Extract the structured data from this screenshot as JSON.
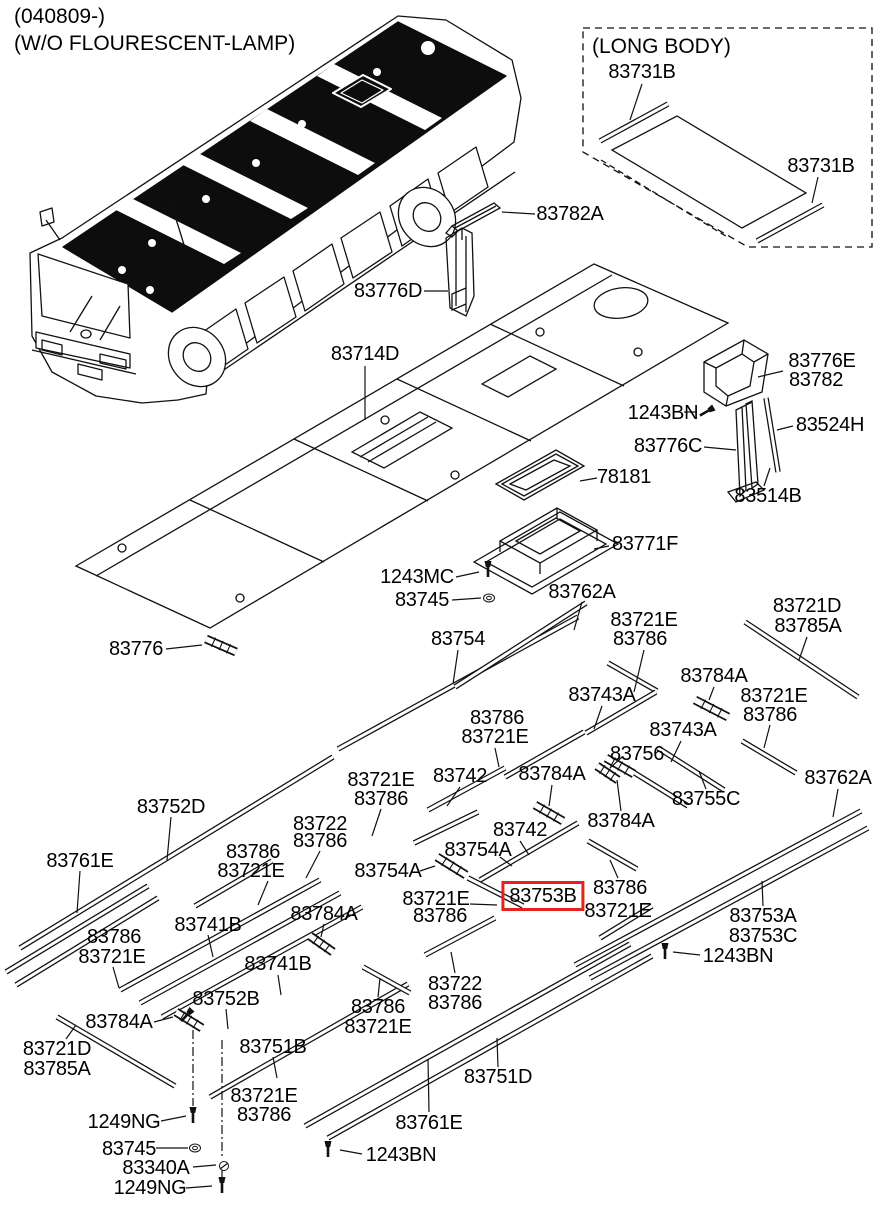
{
  "header": {
    "revision": "(040809-)",
    "variant": "(W/O FLOURESCENT-LAMP)"
  },
  "inset": {
    "title": "(LONG BODY)"
  },
  "highlight": {
    "part": "83753B",
    "color": "#e3231c"
  },
  "colors": {
    "line": "#111111",
    "background": "#ffffff"
  },
  "labels": [
    {
      "t": "83731B",
      "x": 642,
      "y": 72
    },
    {
      "t": "83731B",
      "x": 821,
      "y": 166
    },
    {
      "t": "83782A",
      "x": 570,
      "y": 214
    },
    {
      "t": "83776D",
      "x": 388,
      "y": 291
    },
    {
      "t": "83714D",
      "x": 365,
      "y": 354
    },
    {
      "t": "83776E",
      "x": 822,
      "y": 361
    },
    {
      "t": "83782",
      "x": 816,
      "y": 380
    },
    {
      "t": "1243BN",
      "x": 663,
      "y": 413
    },
    {
      "t": "83524H",
      "x": 830,
      "y": 425
    },
    {
      "t": "83776C",
      "x": 668,
      "y": 446
    },
    {
      "t": "78181",
      "x": 624,
      "y": 477
    },
    {
      "t": "83514B",
      "x": 768,
      "y": 496
    },
    {
      "t": "83771F",
      "x": 645,
      "y": 544
    },
    {
      "t": "1243MC",
      "x": 417,
      "y": 577
    },
    {
      "t": "83745",
      "x": 422,
      "y": 600
    },
    {
      "t": "83762A",
      "x": 582,
      "y": 592
    },
    {
      "t": "83721E",
      "x": 644,
      "y": 620
    },
    {
      "t": "83786",
      "x": 640,
      "y": 639
    },
    {
      "t": "83721D",
      "x": 807,
      "y": 606
    },
    {
      "t": "83785A",
      "x": 808,
      "y": 626
    },
    {
      "t": "83754",
      "x": 458,
      "y": 639
    },
    {
      "t": "83776",
      "x": 136,
      "y": 649
    },
    {
      "t": "83743A",
      "x": 602,
      "y": 695
    },
    {
      "t": "83784A",
      "x": 714,
      "y": 676
    },
    {
      "t": "83721E",
      "x": 774,
      "y": 696
    },
    {
      "t": "83786",
      "x": 770,
      "y": 715
    },
    {
      "t": "83786",
      "x": 497,
      "y": 718
    },
    {
      "t": "83721E",
      "x": 495,
      "y": 737
    },
    {
      "t": "83743A",
      "x": 683,
      "y": 730
    },
    {
      "t": "83756",
      "x": 637,
      "y": 754
    },
    {
      "t": "83742",
      "x": 460,
      "y": 776
    },
    {
      "t": "83784A",
      "x": 552,
      "y": 774
    },
    {
      "t": "83721E",
      "x": 381,
      "y": 780
    },
    {
      "t": "83786",
      "x": 381,
      "y": 799
    },
    {
      "t": "83752D",
      "x": 171,
      "y": 807
    },
    {
      "t": "83755C",
      "x": 706,
      "y": 799
    },
    {
      "t": "83762A",
      "x": 838,
      "y": 778
    },
    {
      "t": "83722",
      "x": 320,
      "y": 824
    },
    {
      "t": "83786",
      "x": 320,
      "y": 841
    },
    {
      "t": "83742",
      "x": 520,
      "y": 830
    },
    {
      "t": "83754A",
      "x": 478,
      "y": 850
    },
    {
      "t": "83754A",
      "x": 388,
      "y": 871
    },
    {
      "t": "83761E",
      "x": 80,
      "y": 861
    },
    {
      "t": "83786",
      "x": 253,
      "y": 852
    },
    {
      "t": "83721E",
      "x": 251,
      "y": 871
    },
    {
      "t": "83784A",
      "x": 621,
      "y": 821
    },
    {
      "t": "83721E",
      "x": 436,
      "y": 899
    },
    {
      "t": "83786",
      "x": 440,
      "y": 916
    },
    {
      "t": "83753B",
      "x": 543,
      "y": 896,
      "box": true
    },
    {
      "t": "83786",
      "x": 620,
      "y": 888
    },
    {
      "t": "83721E",
      "x": 618,
      "y": 911
    },
    {
      "t": "83784A",
      "x": 324,
      "y": 914
    },
    {
      "t": "83741B",
      "x": 208,
      "y": 925
    },
    {
      "t": "83786",
      "x": 114,
      "y": 937
    },
    {
      "t": "83721E",
      "x": 112,
      "y": 957
    },
    {
      "t": "83741B",
      "x": 278,
      "y": 964
    },
    {
      "t": "83752B",
      "x": 226,
      "y": 999
    },
    {
      "t": "83753A",
      "x": 763,
      "y": 916
    },
    {
      "t": "83753C",
      "x": 763,
      "y": 936
    },
    {
      "t": "1243BN",
      "x": 738,
      "y": 956
    },
    {
      "t": "83784A",
      "x": 119,
      "y": 1022
    },
    {
      "t": "83721D",
      "x": 57,
      "y": 1049
    },
    {
      "t": "83785A",
      "x": 57,
      "y": 1069
    },
    {
      "t": "83751B",
      "x": 273,
      "y": 1047
    },
    {
      "t": "83722",
      "x": 455,
      "y": 984
    },
    {
      "t": "83786",
      "x": 455,
      "y": 1003
    },
    {
      "t": "83786",
      "x": 378,
      "y": 1007
    },
    {
      "t": "83721E",
      "x": 378,
      "y": 1027
    },
    {
      "t": "83721E",
      "x": 264,
      "y": 1096
    },
    {
      "t": "83786",
      "x": 264,
      "y": 1115
    },
    {
      "t": "1249NG",
      "x": 124,
      "y": 1122
    },
    {
      "t": "83745",
      "x": 129,
      "y": 1149
    },
    {
      "t": "83340A",
      "x": 156,
      "y": 1168
    },
    {
      "t": "1249NG",
      "x": 150,
      "y": 1188
    },
    {
      "t": "83751D",
      "x": 498,
      "y": 1077
    },
    {
      "t": "83761E",
      "x": 429,
      "y": 1123
    },
    {
      "t": "1243BN",
      "x": 401,
      "y": 1155
    }
  ]
}
